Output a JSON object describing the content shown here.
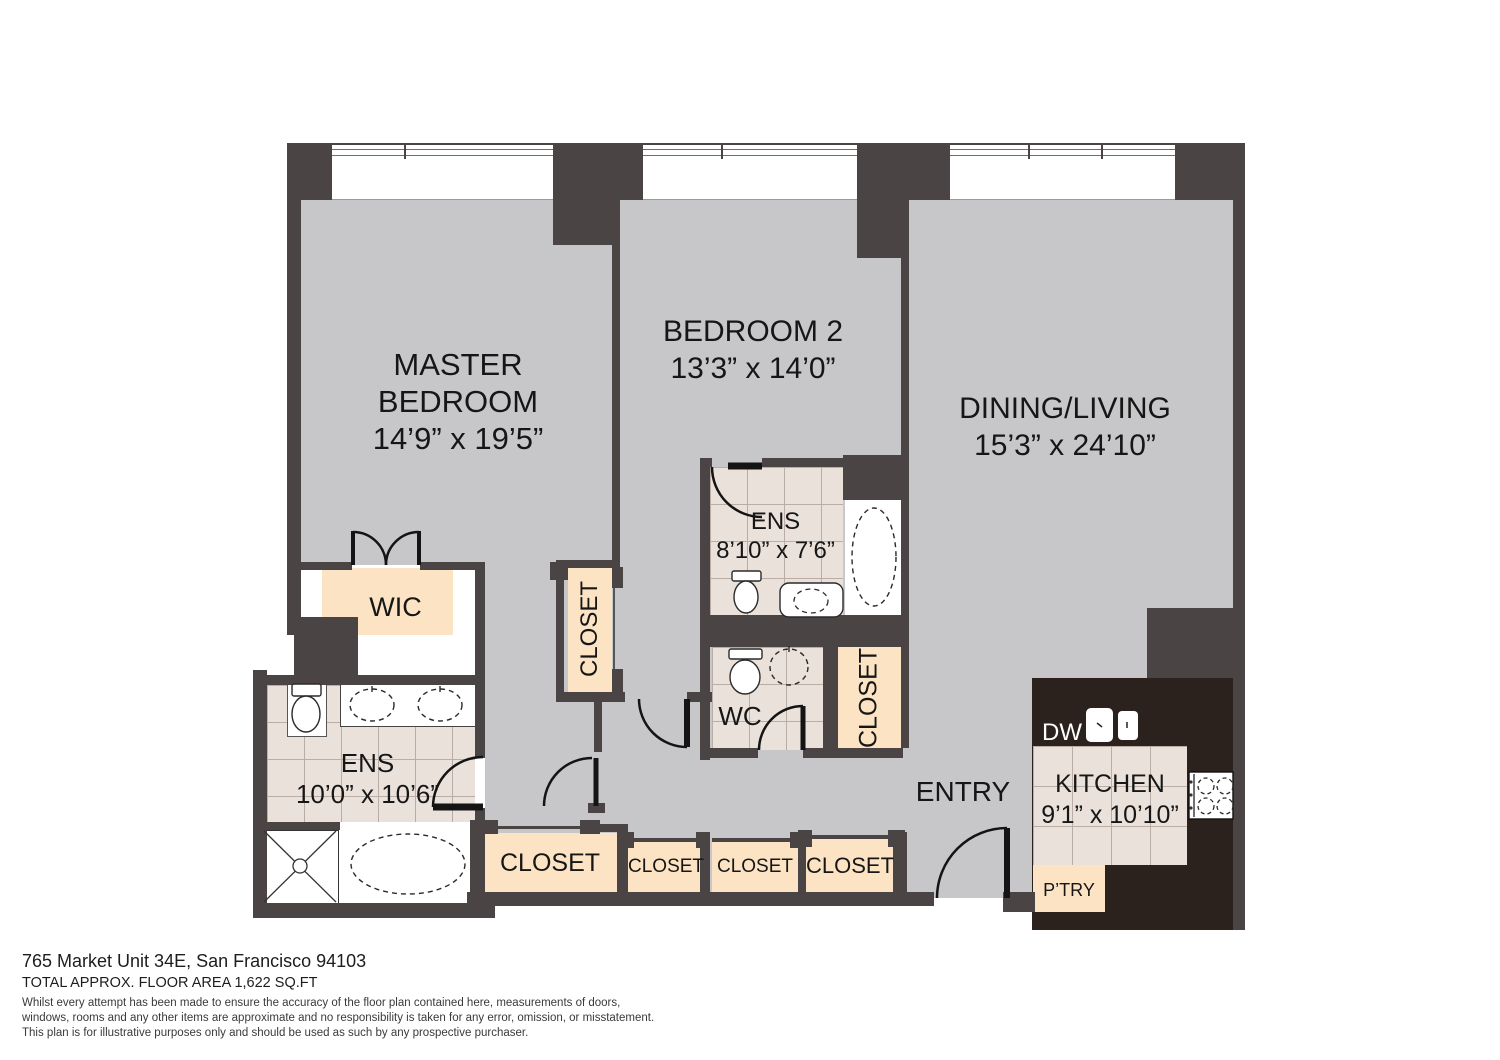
{
  "rooms": {
    "master_bedroom": {
      "name_line1": "MASTER",
      "name_line2": "BEDROOM",
      "dims": "14’9” x 19’5”"
    },
    "bedroom2": {
      "name": "BEDROOM 2",
      "dims": "13’3” x 14’0”"
    },
    "dining_living": {
      "name": "DINING/LIVING",
      "dims": "15’3” x 24’10”"
    },
    "ens_bedroom2": {
      "name": "ENS",
      "dims": "8’10” x 7’6”"
    },
    "ens_master": {
      "name": "ENS",
      "dims": "10’0” x 10’6”"
    },
    "wc": {
      "name": "WC"
    },
    "wic": {
      "name": "WIC"
    },
    "entry": {
      "name": "ENTRY"
    },
    "kitchen": {
      "name": "KITCHEN",
      "dims": "9’1” x 10’10”"
    },
    "pantry": {
      "name": "P’TRY"
    },
    "dishwasher": {
      "name": "DW"
    },
    "closet": {
      "name": "CLOSET"
    }
  },
  "footer": {
    "address": "765 Market Unit 34E, San Francisco 94103",
    "area": "TOTAL APPROX. FLOOR AREA 1,622 SQ.FT",
    "disclaimer": [
      "Whilst every attempt has been made to ensure the accuracy of the floor plan contained here, measurements of doors,",
      "windows, rooms and any other items are approximate and no responsibility is taken for any error, omission, or misstatement.",
      "This plan is for illustrative purposes only and should be used as such by any prospective purchaser."
    ]
  },
  "colors": {
    "wall": "#4a4445",
    "floor": "#c7c7c9",
    "kitchen_counter": "#2b211d",
    "tile": "#eae1da",
    "closet_fill": "#fbe3c4"
  }
}
